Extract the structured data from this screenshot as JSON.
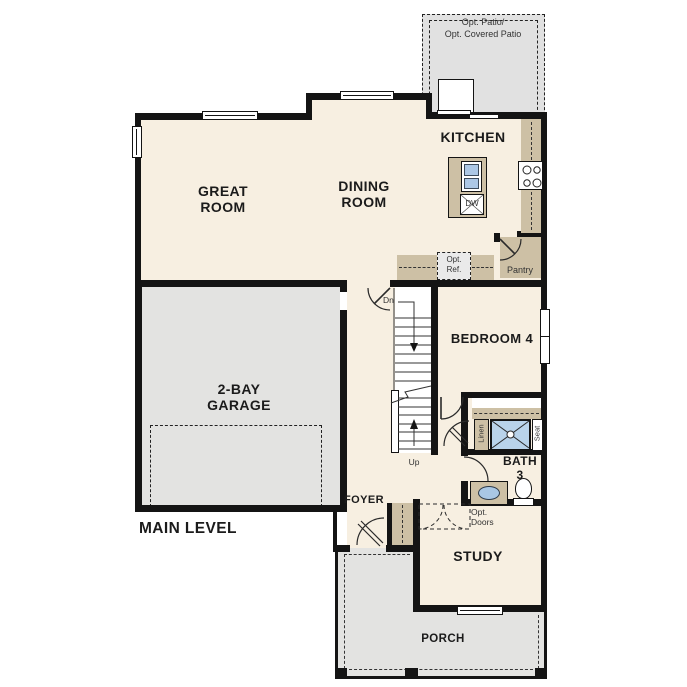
{
  "plan": {
    "title": "MAIN LEVEL",
    "rooms": {
      "great_room": "GREAT ROOM",
      "dining_room": "DINING ROOM",
      "kitchen": "KITCHEN",
      "bedroom4": "BEDROOM 4",
      "garage": "2-BAY GARAGE",
      "study": "STUDY",
      "foyer": "FOYER",
      "bath_name": "BATH",
      "bath_number": "3",
      "porch": "PORCH"
    },
    "annotations": {
      "opt_patio_line1": "Opt. Patio/",
      "opt_patio_line2": "Opt. Covered Patio",
      "opt_ref_line1": "Opt.",
      "opt_ref_line2": "Ref.",
      "pantry": "Pantry",
      "stairs_down": "Dn",
      "stairs_up": "Up",
      "linen": "Linen",
      "seat": "Seat",
      "dishwasher": "DW",
      "opt_doors_line1": "Opt.",
      "opt_doors_line2": "Doors"
    },
    "colors": {
      "floor_cream": "#f7efe1",
      "room_gray": "#e3e3e1",
      "patio_gray": "#e1e1e1",
      "cabinet_tan": "#cdc0a5",
      "fixture_blue": "#b9d3ea",
      "wall_black": "#141414",
      "optional_item_gray": "#eaeaea"
    }
  }
}
